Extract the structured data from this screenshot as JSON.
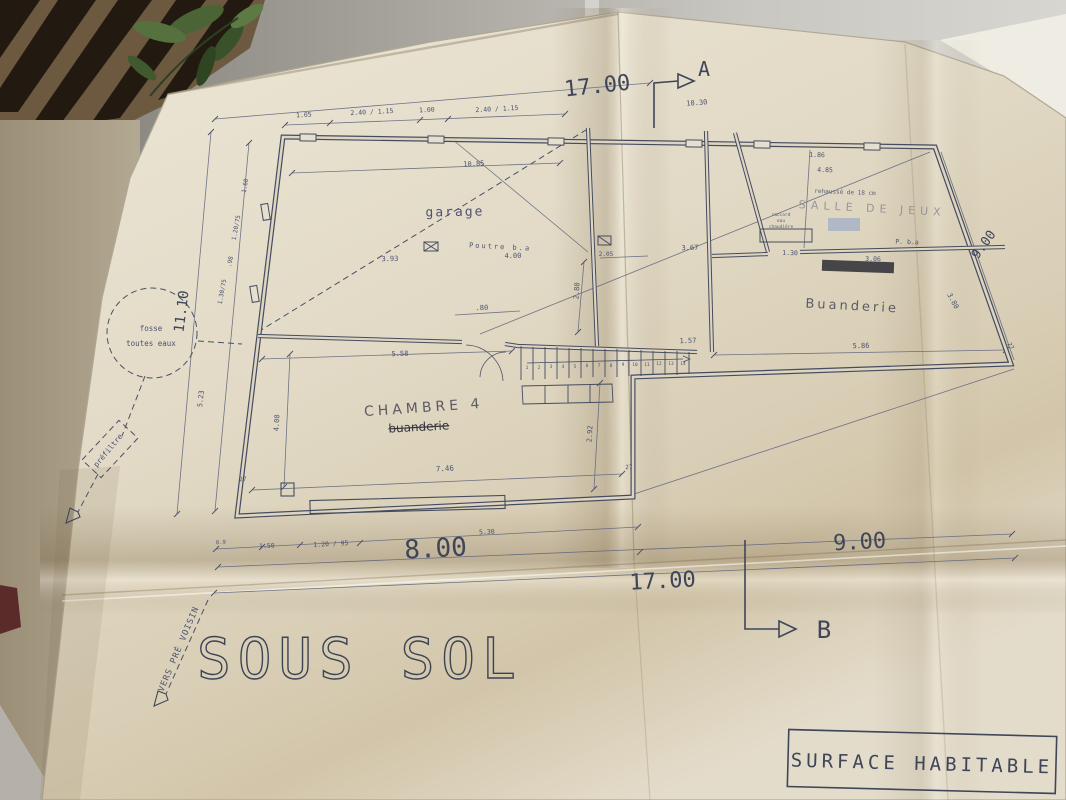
{
  "scene": {
    "titles": {
      "plan_title": "SOUS SOL",
      "title_block": "SURFACE HABITABLE"
    },
    "room_labels": {
      "garage": "garage",
      "chambre4": "CHAMBRE 4",
      "buanderie_struck": "buanderie",
      "buanderie_hand": "Buanderie",
      "salle_de_jeux": "SALLE DE JEUX"
    },
    "section_marks": {
      "a": "A",
      "b": "B"
    },
    "site": {
      "fosse_line1": "fosse",
      "fosse_line2": "toutes eaux",
      "prefiltre": "préfiltre",
      "vers_pre_voisin": "VERS PRÉ VOISIN"
    },
    "notes": {
      "poutre_ba": "Poutre b.a",
      "p_ba": "P. b.a",
      "rehausse": "rehaussé de 18 cm",
      "chaud1": "raccord",
      "chaud2": "eau",
      "chaud3": "chaudière"
    },
    "dims": {
      "top_17": "17.00",
      "bottom_17": "17.00",
      "w8": "8.00",
      "w9": "9.00",
      "left_h": "11.10",
      "right_9": "9.00",
      "a_offset": "10.30",
      "t1": "1.05",
      "t2": "2.40 / 1.15",
      "t3": "1.00",
      "t4": "2.40 / 1.15",
      "g_width": "10.85",
      "g1": "3.93",
      "g2": "4.00",
      "g_door": ".80",
      "c1": "7.46",
      "c2": "5.58",
      "c3": "4.00",
      "c4": "2.92",
      "c_w1": "27",
      "c_w2": "27",
      "b1": "0.9",
      "b2": "1.50",
      "b3": "1.20 / 95",
      "b4": "5.30",
      "m1": "2.05",
      "m2": "3.67",
      "m3": "2.80",
      "m4": "1.57",
      "r1": "1.86",
      "r2": "4.85",
      "r3": "1.30",
      "r4": "3.06",
      "r5": "5.86",
      "r6": "3.80",
      "r_w": "27",
      "l1": "1.60",
      "l2": "1.20/75",
      "l3": ".98",
      "l4": "1.30/75",
      "l5": "5.23"
    },
    "stairs": {
      "steps": [
        "1",
        "2",
        "3",
        "4",
        "5",
        "6",
        "7",
        "8",
        "9",
        "10",
        "11",
        "12",
        "13",
        "14"
      ]
    },
    "colors": {
      "ink": "#4a5166",
      "pencil": "#6f6f76",
      "paper": "#e2dac7",
      "blue_smudge": "#8aa0cc"
    }
  }
}
